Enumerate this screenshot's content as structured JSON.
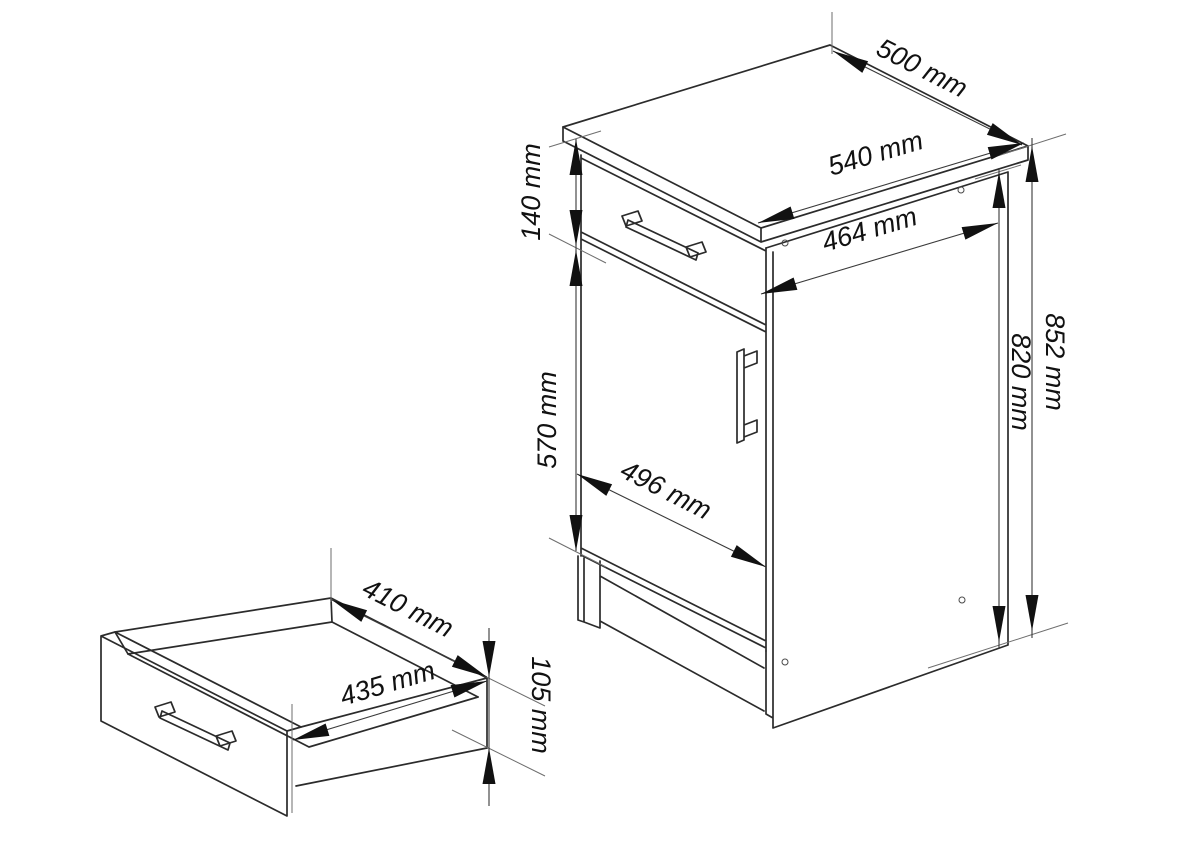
{
  "diagram": {
    "kind": "furniture technical drawing",
    "views": {
      "cabinet": "base cabinet with drawer and door, isometric view",
      "drawer": "pull-out drawer box, isometric view"
    },
    "dims": {
      "top_depth": "500 mm",
      "top_width": "540 mm",
      "side_depth": "464 mm",
      "drawer_front_height": "140 mm",
      "door_height": "570 mm",
      "front_width": "496 mm",
      "total_height": "852 mm",
      "body_height": "820 mm",
      "drawer_inner_width": "410 mm",
      "drawer_depth": "435 mm",
      "drawer_side_height": "105 mm"
    }
  }
}
